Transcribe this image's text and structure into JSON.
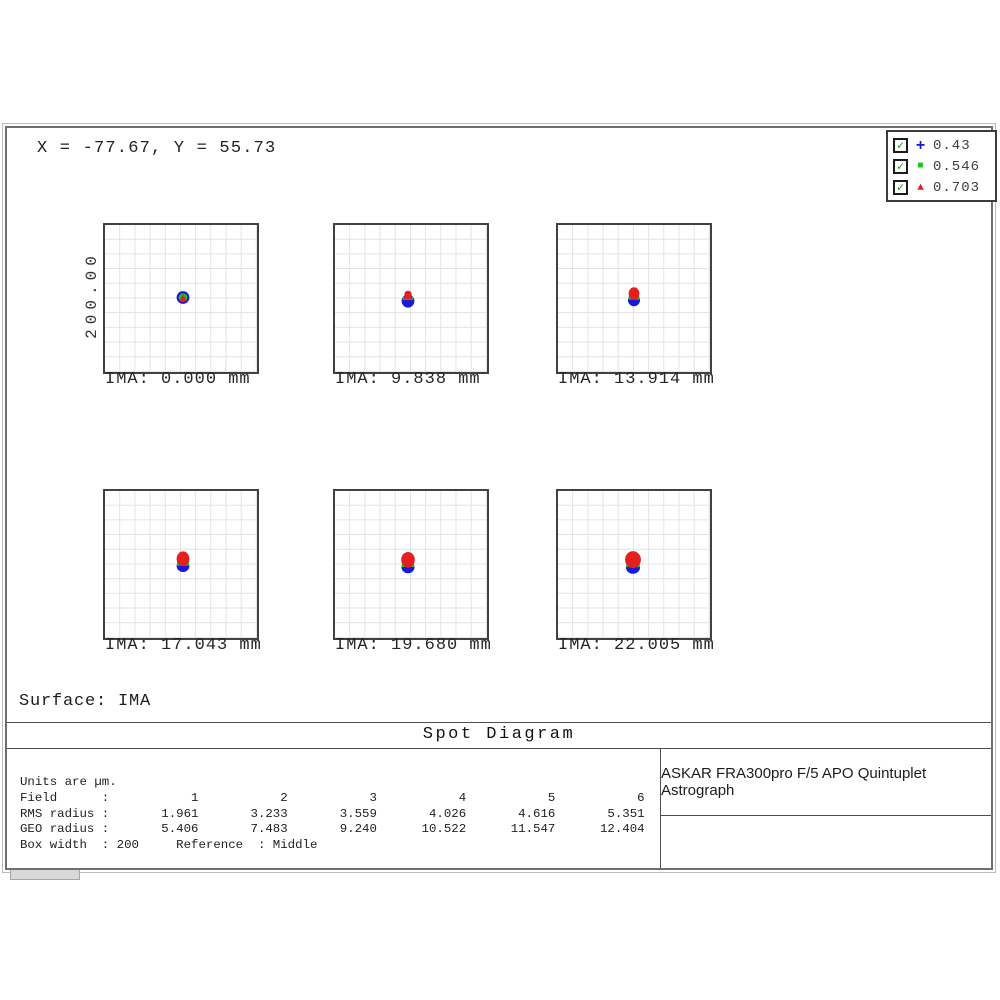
{
  "window": {
    "coords_readout": "X = -77.67, Y = 55.73",
    "surface_label": "Surface: IMA",
    "title": "Spot Diagram",
    "lens_title": "ASKAR FRA300pro F/5 APO Quintuplet Astrograph",
    "stats": {
      "lines": [
        "Units are µm.",
        "Field      :           1           2           3           4           5           6",
        "RMS radius :       1.961       3.233       3.559       4.026       4.616       5.351",
        "GEO radius :       5.406       7.483       9.240      10.522      11.547      12.404",
        "Box width  : 200     Reference  : Middle"
      ]
    },
    "legend": {
      "items": [
        {
          "checked": true,
          "check_glyph": "✓",
          "marker": "plus-marker",
          "label": "0.43"
        },
        {
          "checked": true,
          "check_glyph": "✓",
          "marker": "square-marker",
          "label": "0.546"
        },
        {
          "checked": true,
          "check_glyph": "✓",
          "marker": "triangle-marker",
          "label": "0.703"
        }
      ]
    }
  },
  "chart_data": {
    "type": "scatter",
    "subtype": "optical-spot-diagram",
    "title": "Spot Diagram",
    "surface": "IMA",
    "scale_label": "200.00",
    "units": "µm",
    "box_width_um": 200,
    "reference": "Middle",
    "wavelengths_um": [
      "0.43",
      "0.546",
      "0.703"
    ],
    "legend_position": "top-right",
    "grid": "on",
    "colors": {
      "blue": "#1717dd",
      "green": "#0fc818",
      "red": "#e51f1f"
    },
    "fields": [
      {
        "index": 1,
        "label": "IMA: 0.000 mm",
        "ima_mm": 0.0,
        "rms_radius_um": 1.961,
        "geo_radius_um": 5.406,
        "spot_layers": [
          [
            "e",
            0,
            0.5,
            6.4,
            6.4,
            "blue"
          ],
          [
            "e",
            0,
            0.5,
            4.3,
            4.3,
            "green"
          ],
          [
            "t",
            0,
            1.2,
            4.0,
            "red"
          ]
        ]
      },
      {
        "index": 2,
        "label": "IMA: 9.838 mm",
        "ima_mm": 9.838,
        "rms_radius_um": 3.233,
        "geo_radius_um": 7.483,
        "spot_layers": [
          [
            "e",
            0,
            2,
            6.4,
            6.6,
            "blue"
          ],
          [
            "r",
            0,
            -0.6,
            10.6,
            3.4,
            "green"
          ],
          [
            "t",
            0,
            -3.4,
            5.0,
            "red"
          ],
          [
            "e",
            0,
            -4.8,
            3.7,
            3.5,
            "red"
          ]
        ]
      },
      {
        "index": 3,
        "label": "IMA: 13.914 mm",
        "ima_mm": 13.914,
        "rms_radius_um": 3.559,
        "geo_radius_um": 9.24,
        "spot_layers": [
          [
            "e",
            0,
            3.2,
            6.0,
            6.0,
            "blue"
          ],
          [
            "r",
            0,
            0.9,
            10.8,
            3.4,
            "green"
          ],
          [
            "e",
            0,
            -3.4,
            5.4,
            6.4,
            "red"
          ]
        ]
      },
      {
        "index": 4,
        "label": "IMA: 17.043 mm",
        "ima_mm": 17.043,
        "rms_radius_um": 4.026,
        "geo_radius_um": 10.522,
        "spot_layers": [
          [
            "e",
            0,
            4,
            6.4,
            6.0,
            "blue"
          ],
          [
            "r",
            0,
            1.9,
            12,
            3.6,
            "green"
          ],
          [
            "e",
            0,
            -3.2,
            6.4,
            7.4,
            "red"
          ]
        ]
      },
      {
        "index": 5,
        "label": "IMA: 19.680 mm",
        "ima_mm": 19.68,
        "rms_radius_um": 4.616,
        "geo_radius_um": 11.547,
        "spot_layers": [
          [
            "e",
            0,
            4.3,
            6.5,
            6.0,
            "blue"
          ],
          [
            "r",
            0,
            2.2,
            12.2,
            3.6,
            "green"
          ],
          [
            "e",
            0,
            -3.2,
            6.8,
            7.8,
            "red"
          ]
        ]
      },
      {
        "index": 6,
        "label": "IMA: 22.005 mm",
        "ima_mm": 22.005,
        "rms_radius_um": 5.351,
        "geo_radius_um": 12.404,
        "spot_layers": [
          [
            "e",
            0,
            5.6,
            7.0,
            6.2,
            "blue"
          ],
          [
            "r",
            0,
            3.4,
            13.4,
            3.4,
            "green"
          ],
          [
            "e",
            0,
            -2.4,
            7.9,
            8.5,
            "red"
          ]
        ]
      }
    ]
  }
}
